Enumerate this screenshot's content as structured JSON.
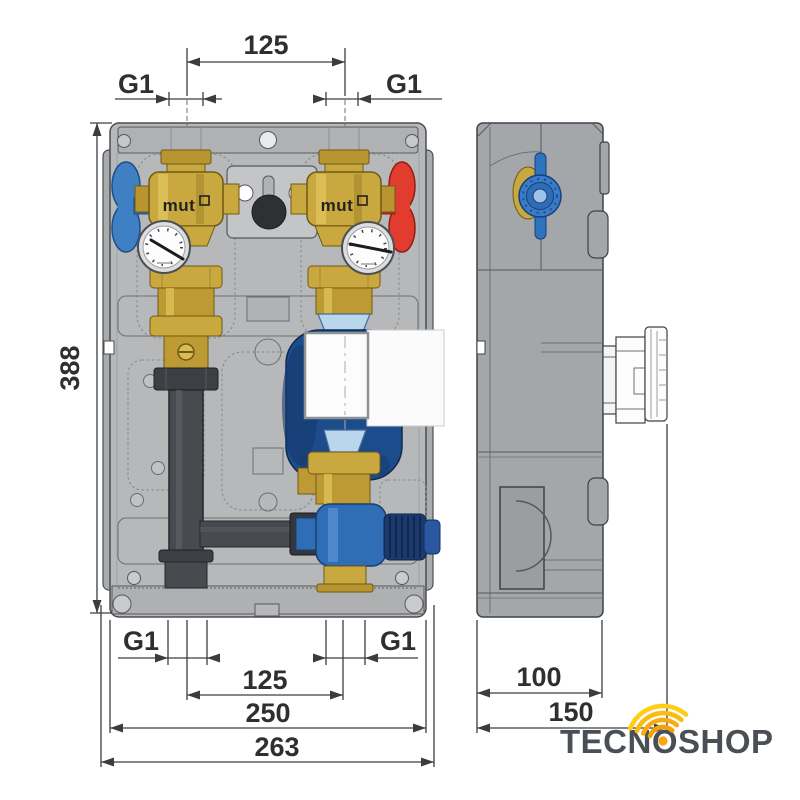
{
  "drawing": {
    "front_view": {
      "valve_brand_left": "mut",
      "valve_brand_right": "mut",
      "dim_port_spacing_top": "125",
      "port_size_top_left": "G1",
      "port_size_top_right": "G1",
      "dim_height": "388",
      "port_size_bottom_left": "G1",
      "port_size_bottom_right": "G1",
      "dim_port_spacing_bottom": "125",
      "dim_body_width": "250",
      "dim_overall_width": "263"
    },
    "side_view": {
      "dim_depth": "100",
      "dim_overall_depth": "150"
    },
    "colors": {
      "brass": "#c9a83f",
      "cold_handle_blue": "#3f80c4",
      "hot_handle_red": "#e23c2e",
      "pump_navy": "#1c4c8c",
      "pipe_dark_gray": "#474b4f",
      "mixing_valve_blue": "#2f6db5",
      "insulation_gray": "#b5b7b9",
      "dimension_ink": "#3a3d40"
    }
  },
  "branding": {
    "logo_text": "TECNOSHOP",
    "logo_ink": "#4a4f55",
    "logo_accent": "#f7a80d"
  }
}
